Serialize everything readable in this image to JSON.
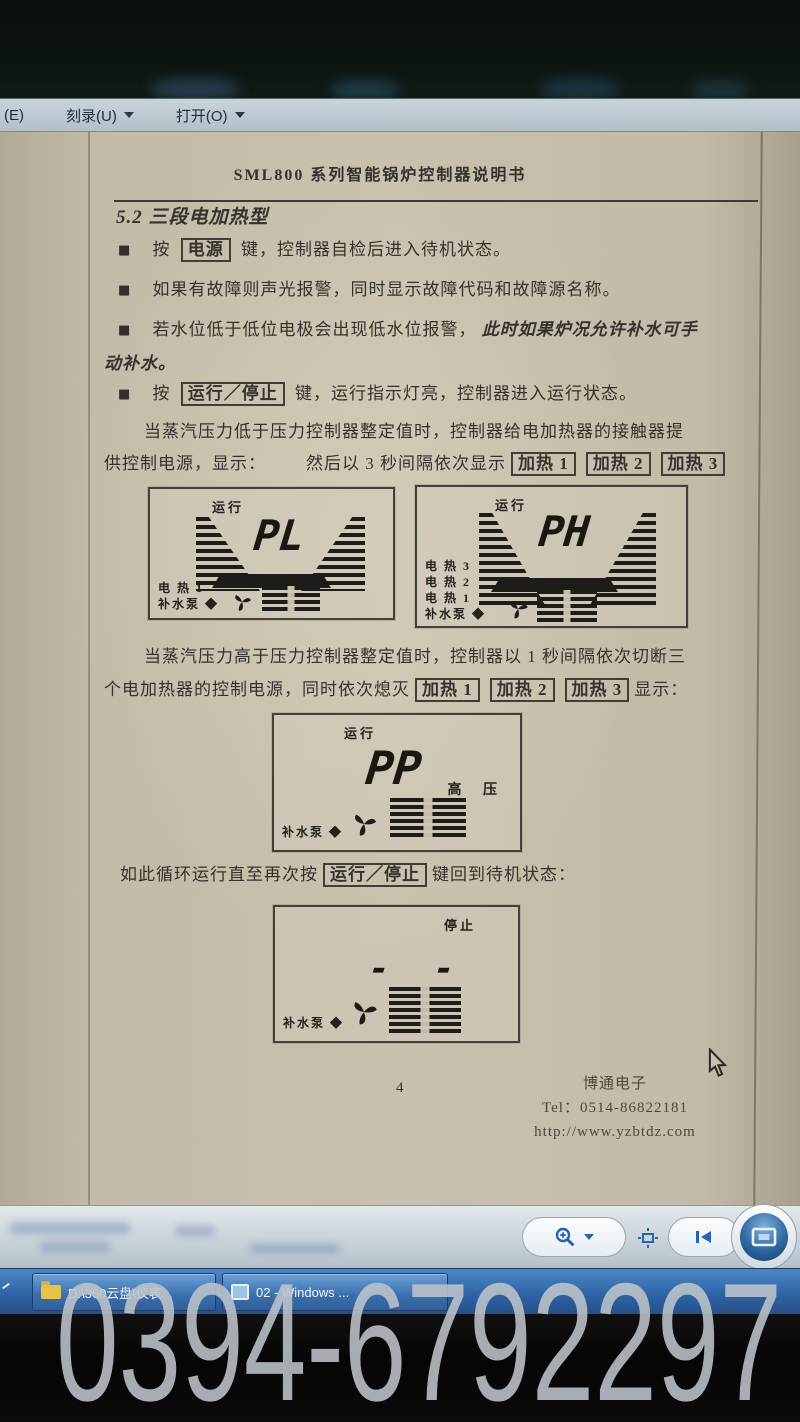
{
  "menubar": {
    "left_fragment": "(E)",
    "items": [
      {
        "label": "刻录(U)"
      },
      {
        "label": "打开(O)"
      }
    ]
  },
  "document": {
    "header_title": "SML800 系列智能锅炉控制器说明书",
    "section_heading": "5.2 三段电加热型",
    "bullet_marker": "■",
    "bullets": [
      {
        "pre": "按",
        "key": "电源",
        "post": "键，控制器自检后进入待机状态。"
      },
      {
        "text": "如果有故障则声光报警，同时显示故障代码和故障源名称。"
      },
      {
        "pre": "若水位低于低位电极会出现低水位报警，",
        "italic": "此时如果炉况允许补水可手",
        "italic2": "动补水。"
      },
      {
        "pre": "按",
        "key": "运行／停止",
        "post": "键，运行指示灯亮，控制器进入运行状态。"
      }
    ],
    "para1": {
      "line1": "当蒸汽压力低于压力控制器整定值时，控制器给电加热器的接触器提",
      "line2_a": "供控制电源，显示：",
      "line2_b": "然后以 3 秒间隔依次显示",
      "keys": [
        "加热 1",
        "加热 2",
        "加热 3"
      ]
    },
    "para2": {
      "line1": "当蒸汽压力高于压力控制器整定值时，控制器以 1 秒间隔依次切断三",
      "line2_a": "个电加热器的控制电源，同时依次熄灭",
      "keys": [
        "加热 1",
        "加热 2",
        "加热 3"
      ],
      "line2_b": "显示："
    },
    "para3": {
      "pre": "如此循环运行直至再次按",
      "key": "运行／停止",
      "post": "键回到待机状态："
    },
    "lcds": [
      {
        "status": "运行",
        "value": "PL",
        "left_labels": [
          "电 热 1",
          "补水泵 ◆"
        ]
      },
      {
        "status": "运行",
        "value": "PH",
        "left_labels": [
          "电 热 3",
          "电 热 2",
          "电 热 1",
          "补水泵 ◆"
        ]
      },
      {
        "status": "运行",
        "value": "PP",
        "left_labels": [
          "补水泵 ◆"
        ],
        "right_label": "高 压"
      },
      {
        "status": "停止",
        "value": "- -",
        "left_labels": [
          "补水泵 ◆"
        ]
      }
    ],
    "footer": {
      "page_number": "4",
      "company": "博通电子",
      "tel": "Tel：0514-86822181",
      "url": "http://www.yzbtdz.com"
    }
  },
  "taskbar": {
    "buttons": [
      {
        "label": "D:\\360云盘\\仪表..."
      },
      {
        "label": "02 - Windows ..."
      }
    ]
  },
  "watermark": "0394-6792297",
  "colors": {
    "taskbar_blue": "#2f64a6",
    "toolbar_icon_blue": "#2565ae",
    "page_beige": "#c7c0ac"
  }
}
